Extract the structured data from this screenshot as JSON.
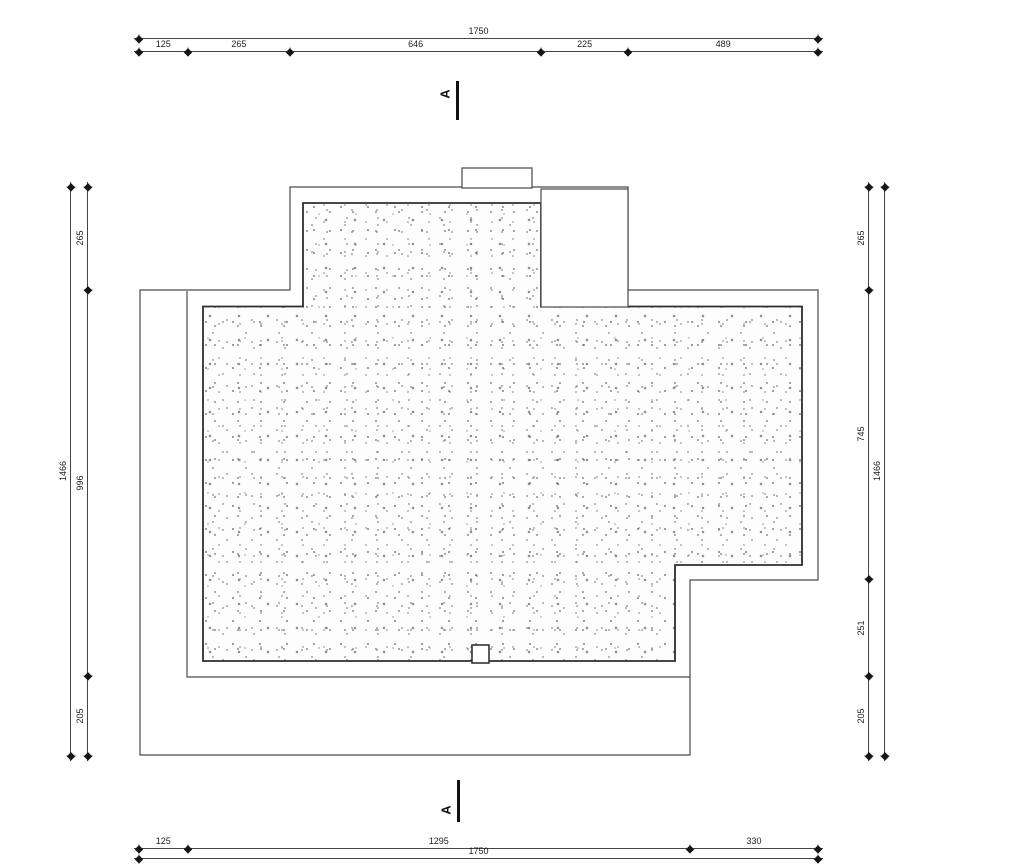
{
  "section_markers": {
    "top": "A",
    "bottom": "A"
  },
  "dimensions": {
    "top_total": [
      "1750"
    ],
    "top_chain": [
      "125",
      "265",
      "646",
      "225",
      "489"
    ],
    "bottom_chain": [
      "125",
      "1295",
      "330"
    ],
    "bottom_total": [
      "1750"
    ],
    "left_total": [
      "1466"
    ],
    "left_chain": [
      "265",
      "996",
      "205"
    ],
    "right_chain": [
      "265",
      "745",
      "251",
      "205"
    ],
    "right_total": [
      "1466"
    ]
  },
  "colors": {
    "outline": "#4a4a4a",
    "roof_boundary": "#2e2e2e",
    "dimension_line": "#454545",
    "tick": "#161616",
    "text": "#1d1d1d",
    "background": "#ffffff"
  }
}
